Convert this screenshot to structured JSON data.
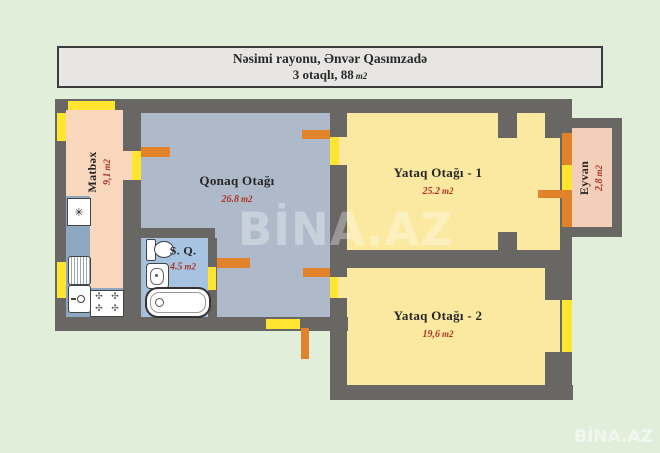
{
  "title_box": {
    "line1": "Nəsimi rayonu, Ənvər Qasımzadə",
    "line2_prefix": "3 otaqlı, 88",
    "line2_unit": "m2"
  },
  "watermarks": {
    "center": "BİNA.AZ",
    "corner": "BİNA.AZ"
  },
  "rooms": {
    "kitchen": {
      "name": "Matbəx",
      "area": "9,1",
      "unit": "m2"
    },
    "living_room": {
      "name": "Qonaq Otağı",
      "area": "26.8",
      "unit": "m2"
    },
    "bathroom": {
      "name": "S. Q.",
      "area": "4.5",
      "unit": "m2"
    },
    "bedroom_1": {
      "name": "Yataq Otağı - 1",
      "area": "25.2",
      "unit": "m2"
    },
    "bedroom_2": {
      "name": "Yataq Otağı - 2",
      "area": "19,6",
      "unit": "m2"
    },
    "balcony": {
      "name": "Eyvan",
      "area": "2,8",
      "unit": "m2"
    }
  },
  "symbols": {
    "appliance": "✳",
    "burner": "✣"
  },
  "colors": {
    "bg": "#e1eeda",
    "wall": "#696764",
    "titleBg": "#e7e6e4",
    "titleBorder": "#3b3b3b",
    "titleText": "#2a2a2a",
    "kitchenFill": "#f8d7bd",
    "livingFill": "#aebaca",
    "bathFill": "#a6c4e2",
    "bedroomFill": "#fce9a1",
    "balconyFill": "#f3cfb9",
    "windowYellow": "#ffe430",
    "doorOrange": "#e2832c",
    "counterBlue": "#8ea8c1",
    "nameText": "#262626",
    "areaText": "#b03427",
    "watermarkWhite": "#ffffff"
  }
}
